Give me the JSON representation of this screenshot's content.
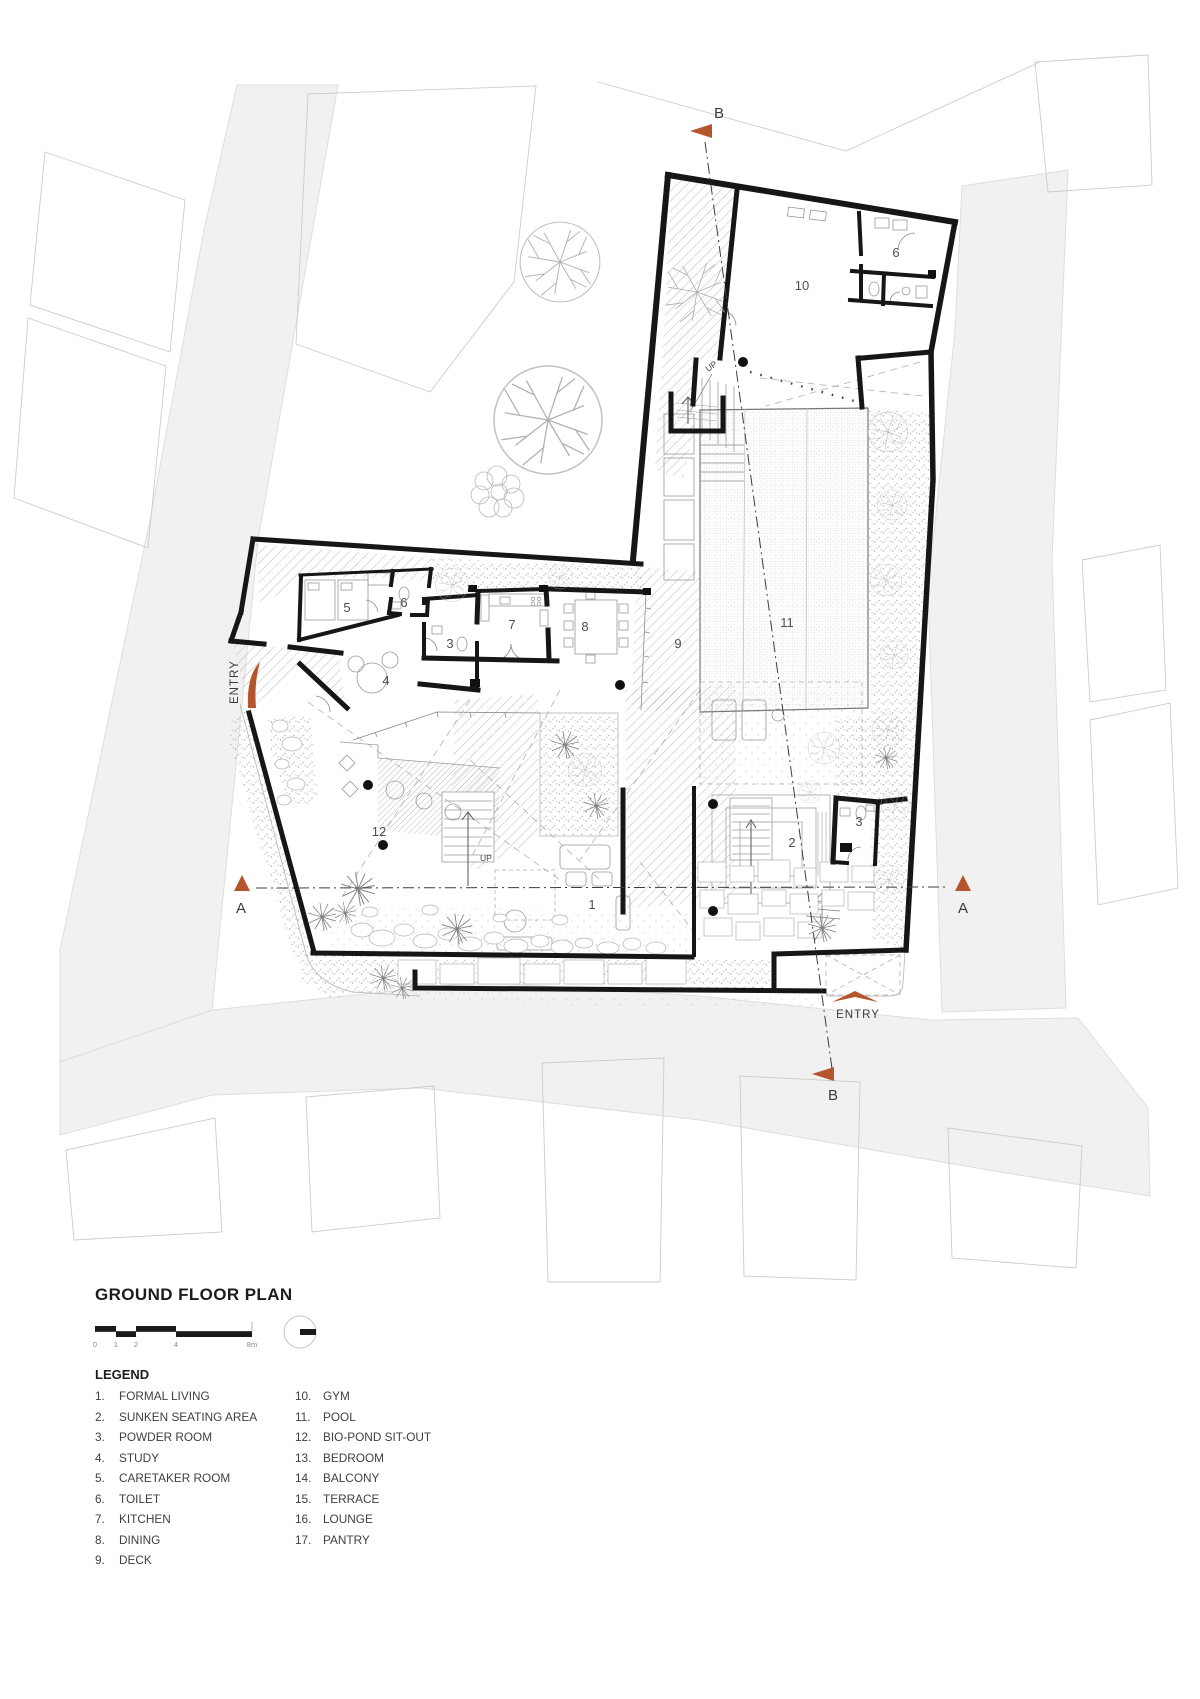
{
  "title": "GROUND FLOOR PLAN",
  "legend": {
    "heading": "LEGEND",
    "col1": [
      {
        "num": "1.",
        "label": "FORMAL LIVING"
      },
      {
        "num": "2.",
        "label": "SUNKEN SEATING AREA"
      },
      {
        "num": "3.",
        "label": "POWDER ROOM"
      },
      {
        "num": "4.",
        "label": "STUDY"
      },
      {
        "num": "5.",
        "label": "CARETAKER ROOM"
      },
      {
        "num": "6.",
        "label": "TOILET"
      },
      {
        "num": "7.",
        "label": "KITCHEN"
      },
      {
        "num": "8.",
        "label": "DINING"
      },
      {
        "num": "9.",
        "label": "DECK"
      }
    ],
    "col2": [
      {
        "num": "10.",
        "label": "GYM"
      },
      {
        "num": "11.",
        "label": "POOL"
      },
      {
        "num": "12.",
        "label": "BIO-POND SIT-OUT"
      },
      {
        "num": "13.",
        "label": "BEDROOM"
      },
      {
        "num": "14.",
        "label": "BALCONY"
      },
      {
        "num": "15.",
        "label": "TERRACE"
      },
      {
        "num": "16.",
        "label": "LOUNGE"
      },
      {
        "num": "17.",
        "label": "PANTRY"
      }
    ]
  },
  "scalebar": {
    "t0": "0",
    "t1": "1",
    "t2": "2",
    "t4": "4",
    "t8": "8m"
  },
  "plan": {
    "rooms": {
      "r1": "1",
      "r2": "2",
      "r3a": "3",
      "r3b": "3",
      "r4": "4",
      "r5": "5",
      "r6a": "6",
      "r6b": "6",
      "r7": "7",
      "r8": "8",
      "r9": "9",
      "r10": "10",
      "r11": "11",
      "r12": "12"
    },
    "sections": {
      "a_left": "A",
      "a_right": "A",
      "b_top": "B",
      "b_bottom": "B"
    },
    "entry_left": "ENTRY",
    "entry_bottom": "ENTRY",
    "up_top": "UP",
    "up_mid": "UP"
  },
  "colors": {
    "accent": "#b4552d",
    "road": "#f1f1f1",
    "wall": "#161616"
  }
}
